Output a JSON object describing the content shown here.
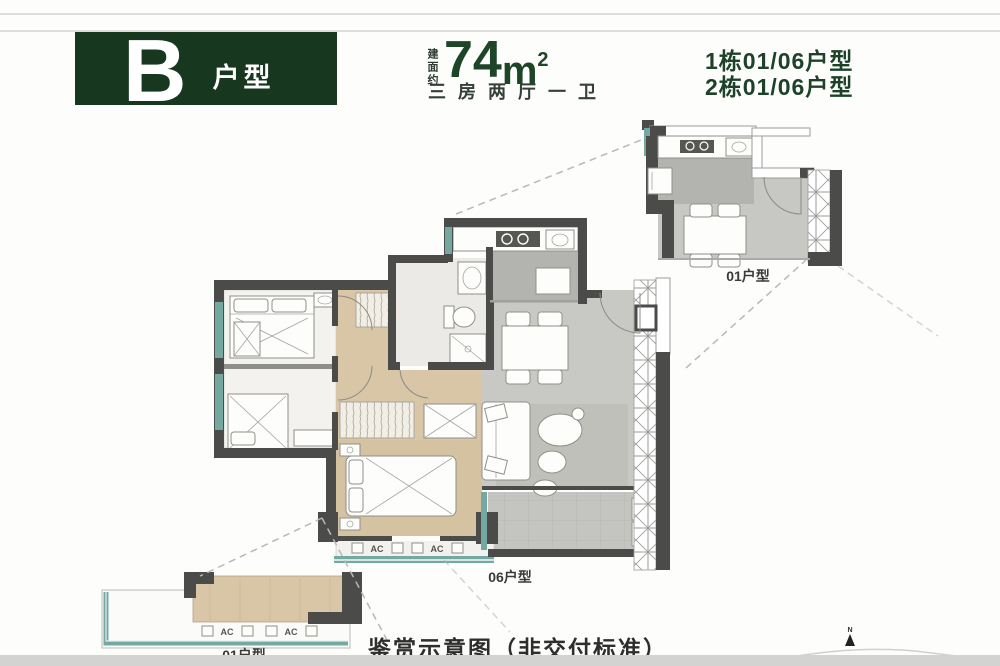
{
  "header": {
    "plan_letter": "B",
    "plan_type": "户型",
    "area_prefix": "建面约",
    "area_value": "74",
    "area_unit": "m",
    "area_sup": "2",
    "rooms_desc": "三房两厅一卫",
    "building_line1": "1栋01/06户型",
    "building_line2": "2栋01/06户型"
  },
  "plan": {
    "main_unit_label": "06户型",
    "inset_top_label": "01户型",
    "inset_bottom_label": "01户型",
    "ac_label": "AC",
    "north_label": "N"
  },
  "footer": {
    "caption": "鉴赏示意图（非交付标准）"
  },
  "colors": {
    "brand_green": "#17381f",
    "text_green": "#1e4527",
    "wall_gray": "#4b4b49",
    "wood": "#d8c6a6",
    "tile_gray": "#c8c8c4",
    "teal_window": "#74a9a1"
  }
}
